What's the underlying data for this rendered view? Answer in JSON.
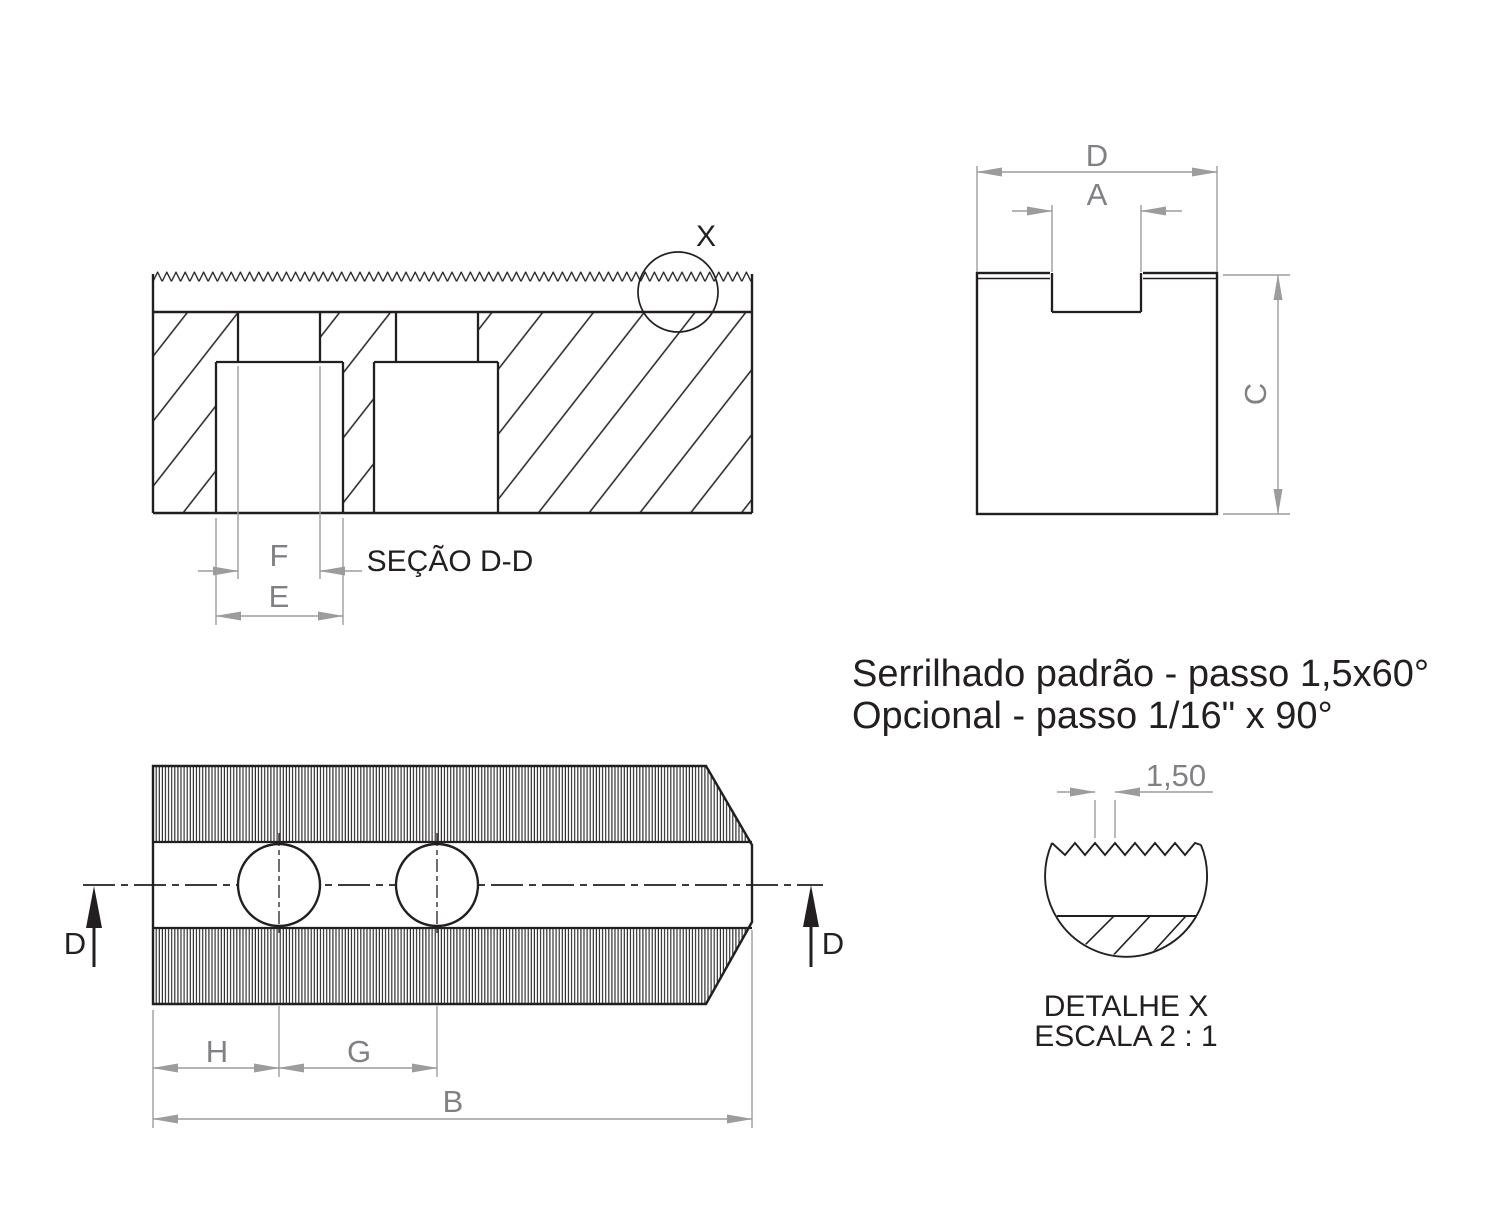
{
  "document": {
    "type": "technical-drawing",
    "language": "pt-BR"
  },
  "notes": {
    "line1": "Serrilhado padrão - passo 1,5x60°",
    "line2": "Opcional  - passo 1/16\" x 90°"
  },
  "section_view": {
    "title": "SEÇÃO D-D",
    "detail_marker": "X",
    "dim_f": "F",
    "dim_e": "E"
  },
  "end_view": {
    "dim_d": "D",
    "dim_a": "A",
    "dim_c": "C"
  },
  "plan_view": {
    "dim_h": "H",
    "dim_g": "G",
    "dim_b": "B",
    "cut_label_left": "D",
    "cut_label_right": "D"
  },
  "detail_view": {
    "title": "DETALHE X",
    "scale": "ESCALA 2 : 1",
    "dim_pitch": "1,50"
  },
  "colors": {
    "line": "#231f20",
    "dim_line": "#9b9c9e",
    "dim_text": "#808184",
    "background": "#ffffff"
  }
}
